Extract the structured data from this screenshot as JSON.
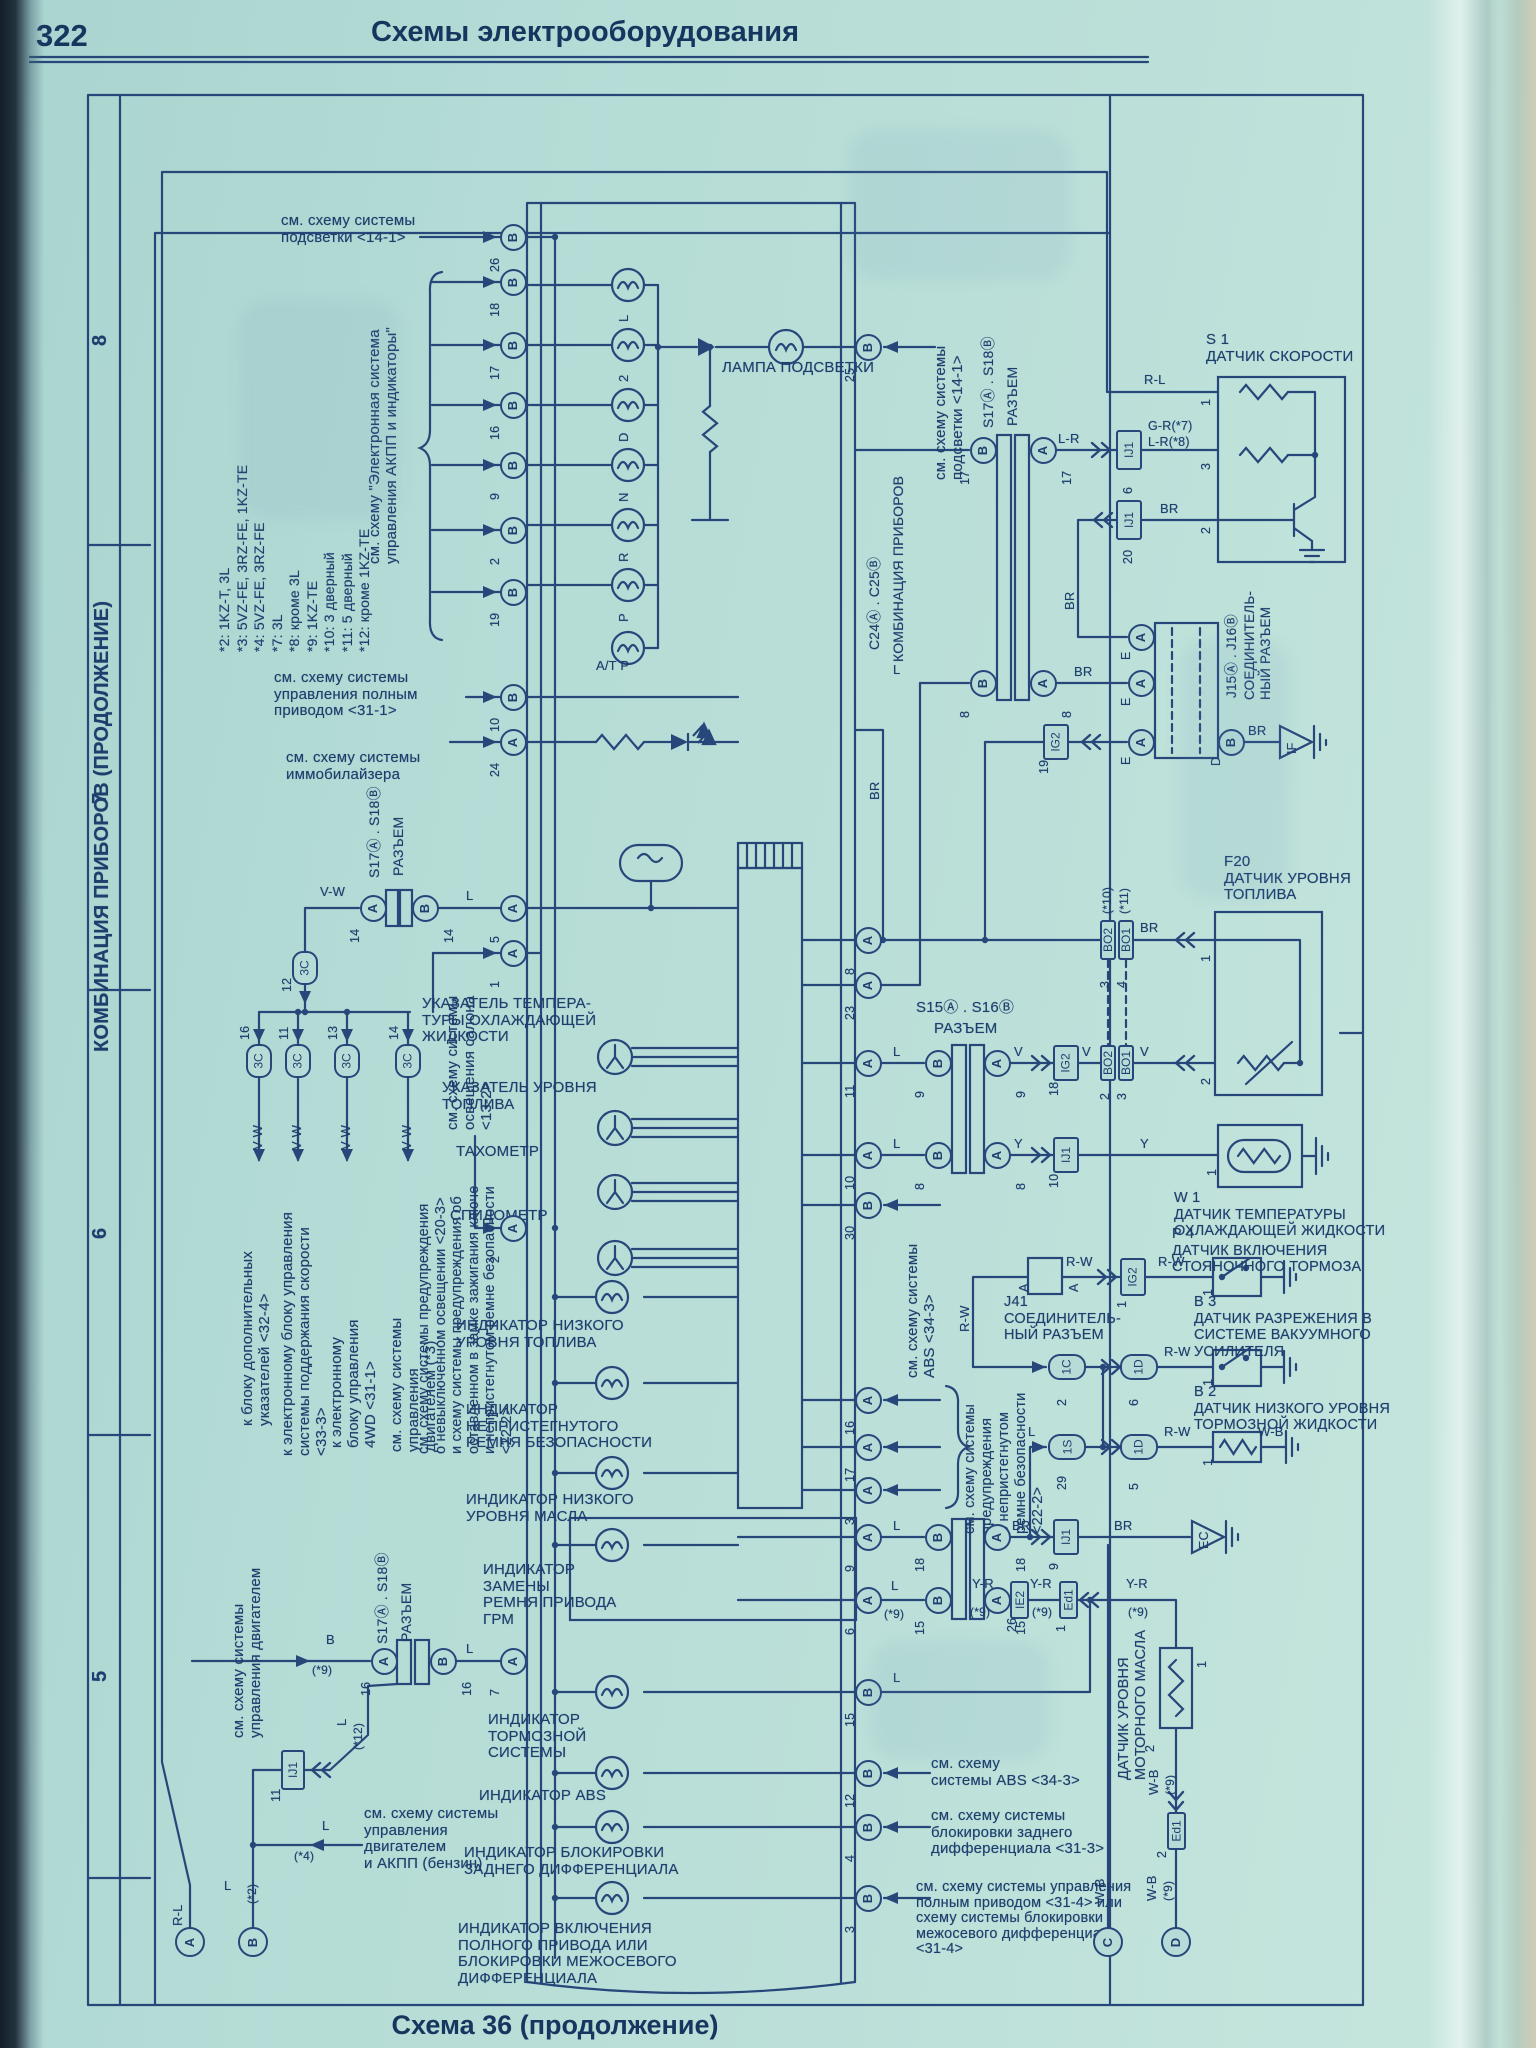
{
  "page": {
    "number": "322",
    "header": "Схемы электрооборудования",
    "caption": "Схема 36 (продолжение)"
  },
  "grid": {
    "rows": [
      "8",
      "7",
      "6",
      "5"
    ]
  },
  "titles": {
    "cluster_vertical": "КОМБИНАЦИЯ ПРИБОРОВ (ПРОДОЛЖЕНИЕ)"
  },
  "notes": "*2: 1KZ-T, 3L\n*3: 5VZ-FE, 3RZ-FE, 1KZ-TE\n*4: 5VZ-FE, 3RZ-FE\n*7: 3L\n*8: кроме 3L\n*9: 1KZ-TE\n*10: 3 дверный\n*11: 5 дверный\n*12: кроме 1KZ-TE",
  "refs": {
    "podsvetka_tl": "см. схему системы\nподсветки <14-1>",
    "akpp": "см. схему \"Электронная система\nуправления АКПП и индикаторы\"",
    "privod": "см. схему системы\nуправления полным\nприводом <31-1>",
    "immob": "см. схему системы\nиммобилайзера",
    "podsvetka_r": "см. схему системы\nподсветки <14-1>",
    "osvesh": "см. схему системы\nосвещения салона\n<13-2>",
    "warn": "см. схему системы предупреждения\nо невыключенном освещении <20-3>\nи схему системы предупреждения об\nоставленном в замке зажигания ключе\nи непристегнутом ремне безопасности\n<22-2>",
    "dop_ukaz": "к блоку дополнительных\nуказателей <32-4>",
    "skorost": "к электронному блоку управления\nсистемы поддержания скорости\n<33-3>",
    "fwd4": "к электронному\nблоку управления\n4WD <31-1>",
    "dvig3": "см. схему системы\nуправления\nдвигателем (*3)",
    "dvig_bl": "см. схему системы\nуправления двигателем",
    "benzin": "см. схему системы\nуправления\nдвигателем\nи АКПП (бензин)",
    "abs_mid": "см. схему системы\nABS <34-3>",
    "belt": "см. схему системы\nпредупреждения\nо непристегнутом\nремне безопасности\n<22-2>",
    "abs_bot": "см. схему\nсистемы ABS <34-3>",
    "diff_bot": "см. схему системы\nблокировки заднего\nдифференциала <31-3>",
    "full_bot": "см. схему системы управления\nполным приводом <31-4> или\nсхему системы блокировки\nмежосевого дифференциала\n<31-4>"
  },
  "cluster": {
    "lamp_podsvetki": "ЛАМПА ПОДСВЕТКИ",
    "gears": [
      "L",
      "2",
      "D",
      "N",
      "R",
      "P"
    ],
    "atp": "A/T P",
    "gauges": [
      "УКАЗАТЕЛЬ ТЕМПЕРА-\nТУРЫ ОХЛАЖДАЮЩЕЙ\nЖИДКОСТИ",
      "УКАЗАТЕЛЬ УРОВНЯ\nТОПЛИВА",
      "ТАХОМЕТР",
      "СПИДОМЕТР"
    ],
    "indicators": [
      "ИНДИКАТОР НИЗКОГО\nУРОВНЯ ТОПЛИВА",
      "ИНДИКАТОР\nНЕПРИСТЕГНУТОГО\nРЕМНЯ БЕЗОПАСНОСТИ",
      "ИНДИКАТОР НИЗКОГО\nУРОВНЯ МАСЛА",
      "ИНДИКАТОР\nЗАМЕНЫ\nРЕМНЯ ПРИВОДА\nГРМ",
      "ИНДИКАТОР\nТОРМОЗНОЙ\nСИСТЕМЫ",
      "ИНДИКАТОР ABS",
      "ИНДИКАТОР БЛОКИРОВКИ\nЗАДНЕГО ДИФФЕРЕНЦИАЛА",
      "ИНДИКАТОР ВКЛЮЧЕНИЯ\nПОЛНОГО ПРИВОДА ИЛИ\nБЛОКИРОВКИ МЕЖОСЕВОГО\nДИФФЕРЕНЦИАЛА"
    ]
  },
  "connectors": {
    "s17s18": "S17Ⓐ . S18Ⓑ",
    "s15s16": "S15Ⓐ . S16Ⓑ",
    "razem": "РАЗЪЕМ",
    "c24c25": "C24Ⓐ . C25Ⓑ",
    "comb": "КОМБИНАЦИЯ ПРИБОРОВ",
    "j41": "J41\nСОЕДИНИТЕЛЬ-\nНЫЙ РАЗЪЕМ",
    "j15j16": "J15Ⓐ . J16Ⓑ",
    "soed": "СОЕДИНИТЕЛЬ-\nНЫЙ РАЗЪЕМ",
    "j41_pin": "A"
  },
  "sensors": {
    "s1": "S 1\nДАТЧИК СКОРОСТИ",
    "f20": "F20\nДАТЧИК УРОВНЯ\nТОПЛИВА",
    "w1": "W 1\nДАТЧИК ТЕМПЕРАТУРЫ\nОХЛАЖДАЮЩЕЙ ЖИДКОСТИ",
    "p4": "P 4\nДАТЧИК ВКЛЮЧЕНИЯ\nСТОЯНОЧНОГО ТОРМОЗА",
    "b3": "B 3\nДАТЧИК РАЗРЕЖЕНИЯ В\nСИСТЕМЕ ВАКУУМНОГО\nУСИЛИТЕЛЯ",
    "b2": "B 2\nДАТЧИК НИЗКОГО УРОВНЯ\nТОРМОЗНОЙ ЖИДКОСТИ",
    "oil": "ДАТЧИК УРОВНЯ\nМОТОРНОГО МАСЛА"
  },
  "sensor_pin_labels": {
    "s1": [
      "1",
      "3",
      "2"
    ],
    "f20": [
      "1",
      "2"
    ],
    "w1": "1",
    "p4": "1",
    "b3": "1",
    "b2": "1",
    "oil": [
      "1",
      "2"
    ],
    "e": "E",
    "d": "D"
  },
  "wires": {
    "vw": "V-W",
    "lr": "L-R",
    "gr7": "G-R(*7)",
    "lr8": "L-R(*8)",
    "rl": "R-L",
    "br": "BR",
    "l": "L",
    "v": "V",
    "y": "Y",
    "yr": "Y-R",
    "wb": "W-B",
    "rw": "R-W",
    "b": "B",
    "s2": "(*2)",
    "s4": "(*4)",
    "s9": "(*9)",
    "s10": "(*10)",
    "s11": "(*11)",
    "s12": "(*12)"
  },
  "grounds": {
    "if": "IF",
    "ec": "EC"
  },
  "corners": [
    "A",
    "B",
    "C",
    "D"
  ],
  "pins": {
    "left": [
      [
        "26",
        "B"
      ],
      [
        "18",
        "B"
      ],
      [
        "17",
        "B"
      ],
      [
        "16",
        "B"
      ],
      [
        "9",
        "B"
      ],
      [
        "2",
        "B"
      ],
      [
        "19",
        "B"
      ],
      [
        "10",
        "B"
      ],
      [
        "24",
        "A"
      ],
      [
        "5",
        "A"
      ],
      [
        "1",
        "A"
      ],
      [
        "2",
        "A"
      ],
      [
        "7",
        "A"
      ]
    ],
    "right": [
      [
        "25",
        "B"
      ],
      [
        "8",
        "A"
      ],
      [
        "23",
        "A"
      ],
      [
        "11",
        "A"
      ],
      [
        "10",
        "A"
      ],
      [
        "30",
        "B"
      ],
      [
        "16",
        "A"
      ],
      [
        "17",
        "A"
      ],
      [
        "3",
        "A"
      ],
      [
        "9",
        "A"
      ],
      [
        "6",
        "A"
      ],
      [
        "15",
        "B"
      ],
      [
        "12",
        "B"
      ],
      [
        "4",
        "B"
      ],
      [
        "3",
        "B"
      ]
    ],
    "s17a": [
      [
        "17",
        "B"
      ],
      [
        "17",
        "A"
      ],
      [
        "8",
        "B"
      ],
      [
        "8",
        "A"
      ]
    ],
    "s17b": [
      [
        "14",
        "A"
      ],
      [
        "14",
        "B"
      ]
    ],
    "s15": [
      [
        "9",
        "B"
      ],
      [
        "9",
        "A"
      ],
      [
        "8",
        "B"
      ],
      [
        "8",
        "A"
      ]
    ],
    "s17c": [
      [
        "16",
        "A"
      ],
      [
        "16",
        "B"
      ]
    ],
    "s17d": [
      [
        "18",
        "B"
      ],
      [
        "18",
        "A"
      ],
      [
        "15",
        "B"
      ],
      [
        "15",
        "A"
      ]
    ],
    "j15": [
      [
        "E",
        "A"
      ],
      [
        "E",
        "A"
      ],
      [
        "E",
        "A"
      ],
      [
        "D",
        "B"
      ]
    ]
  },
  "box_instances": [
    {
      "t": "IJ1",
      "p": "6"
    },
    {
      "t": "IJ1",
      "p": "20"
    },
    {
      "t": "IG2",
      "p": "19"
    },
    {
      "t": "IG2",
      "p": "18"
    },
    {
      "t": "IJ1",
      "p": "10"
    },
    {
      "t": "IG2",
      "p": "1"
    },
    {
      "t": "IJ1",
      "p": "9"
    },
    {
      "t": "IE2",
      "p": "26"
    },
    {
      "t": "Ed1",
      "p": "1"
    },
    {
      "t": "Ed1",
      "p": "2"
    },
    {
      "t": "IJ1",
      "p": "11"
    },
    {
      "t": "BO2",
      "p": "3"
    },
    {
      "t": "BO1",
      "p": "4"
    },
    {
      "t": "BO2",
      "p": "2"
    },
    {
      "t": "BO1",
      "p": "3"
    },
    {
      "t": "3C",
      "p": "12"
    },
    {
      "t": "3C",
      "p": "16"
    },
    {
      "t": "3C",
      "p": "11"
    },
    {
      "t": "3C",
      "p": "13"
    },
    {
      "t": "3C",
      "p": "14"
    },
    {
      "t": "1C",
      "p": "2"
    },
    {
      "t": "1D",
      "p": "6"
    },
    {
      "t": "1S",
      "p": "29"
    },
    {
      "t": "1D",
      "p": "5"
    }
  ]
}
